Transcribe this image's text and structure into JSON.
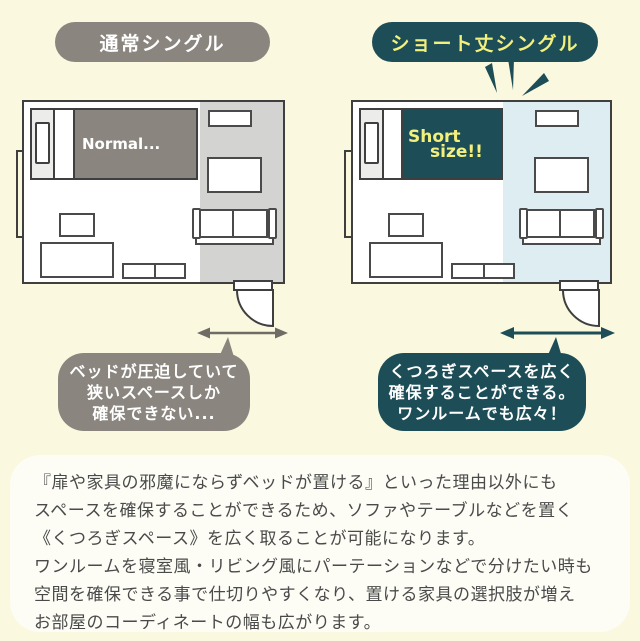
{
  "colors": {
    "background": "#faf8df",
    "gray_accent": "#8a857e",
    "teal_accent": "#1d4e57",
    "yellow_label": "#f3f07e",
    "narrow_space_fill": "#d3d3d1",
    "wide_space_fill": "#ddedf2",
    "outline": "#3f3f3f",
    "body_text": "#4a4a4a"
  },
  "left_panel": {
    "badge_label": "通常シングル",
    "bed_label": "Normal...",
    "bubble": {
      "l1": "ベッドが圧迫していて",
      "l2": "狭いスペースしか",
      "l3": "確保できない..."
    }
  },
  "right_panel": {
    "badge_label": "ショート丈シングル",
    "bed_label_l1": "Short",
    "bed_label_l2": "size!!",
    "bubble": {
      "l1": "くつろぎスペースを広く",
      "l2": "確保することができる。",
      "l3": "ワンルームでも広々！"
    }
  },
  "description": {
    "l1": "『扉や家具の邪魔にならずベッドが置ける』といった理由以外にも",
    "l2": "スペースを確保することができるため、ソファやテーブルなどを置く",
    "l3": "《くつろぎスペース》を広く取ることが可能になります。",
    "l4": "ワンルームを寝室風・リビング風にパーテーションなどで分けたい時も",
    "l5": "空間を確保できる事で仕切りやすくなり、置ける家具の選択肢が増え",
    "l6": "お部屋のコーディネートの幅も広がります。"
  }
}
